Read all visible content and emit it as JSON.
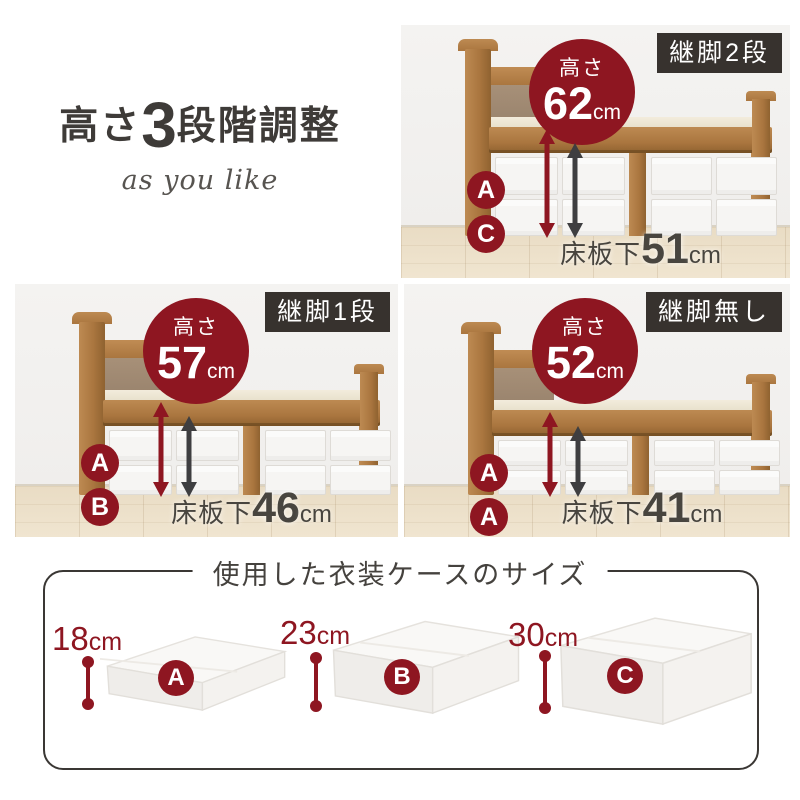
{
  "colors": {
    "accent_red": "#8e1621",
    "badge_bg": "#37322e",
    "text_dark": "#3e3b38"
  },
  "intro": {
    "title_prefix": "高さ",
    "title_number": "3",
    "title_suffix": "段階調整",
    "subtitle": "as you like"
  },
  "labels": {
    "height": "高さ",
    "unit": "cm",
    "under_board": "床板下"
  },
  "panels": [
    {
      "badge": "継脚2段",
      "height_value": "62",
      "under_value": "51",
      "tags": [
        "A",
        "C"
      ]
    },
    {
      "badge": "継脚1段",
      "height_value": "57",
      "under_value": "46",
      "tags": [
        "A",
        "B"
      ]
    },
    {
      "badge": "継脚無し",
      "height_value": "52",
      "under_value": "41",
      "tags": [
        "A",
        "A"
      ]
    }
  ],
  "cases_section": {
    "title": "使用した衣装ケースのサイズ",
    "cases": [
      {
        "label": "A",
        "height_value": "18",
        "unit": "cm"
      },
      {
        "label": "B",
        "height_value": "23",
        "unit": "cm"
      },
      {
        "label": "C",
        "height_value": "30",
        "unit": "cm"
      }
    ]
  }
}
